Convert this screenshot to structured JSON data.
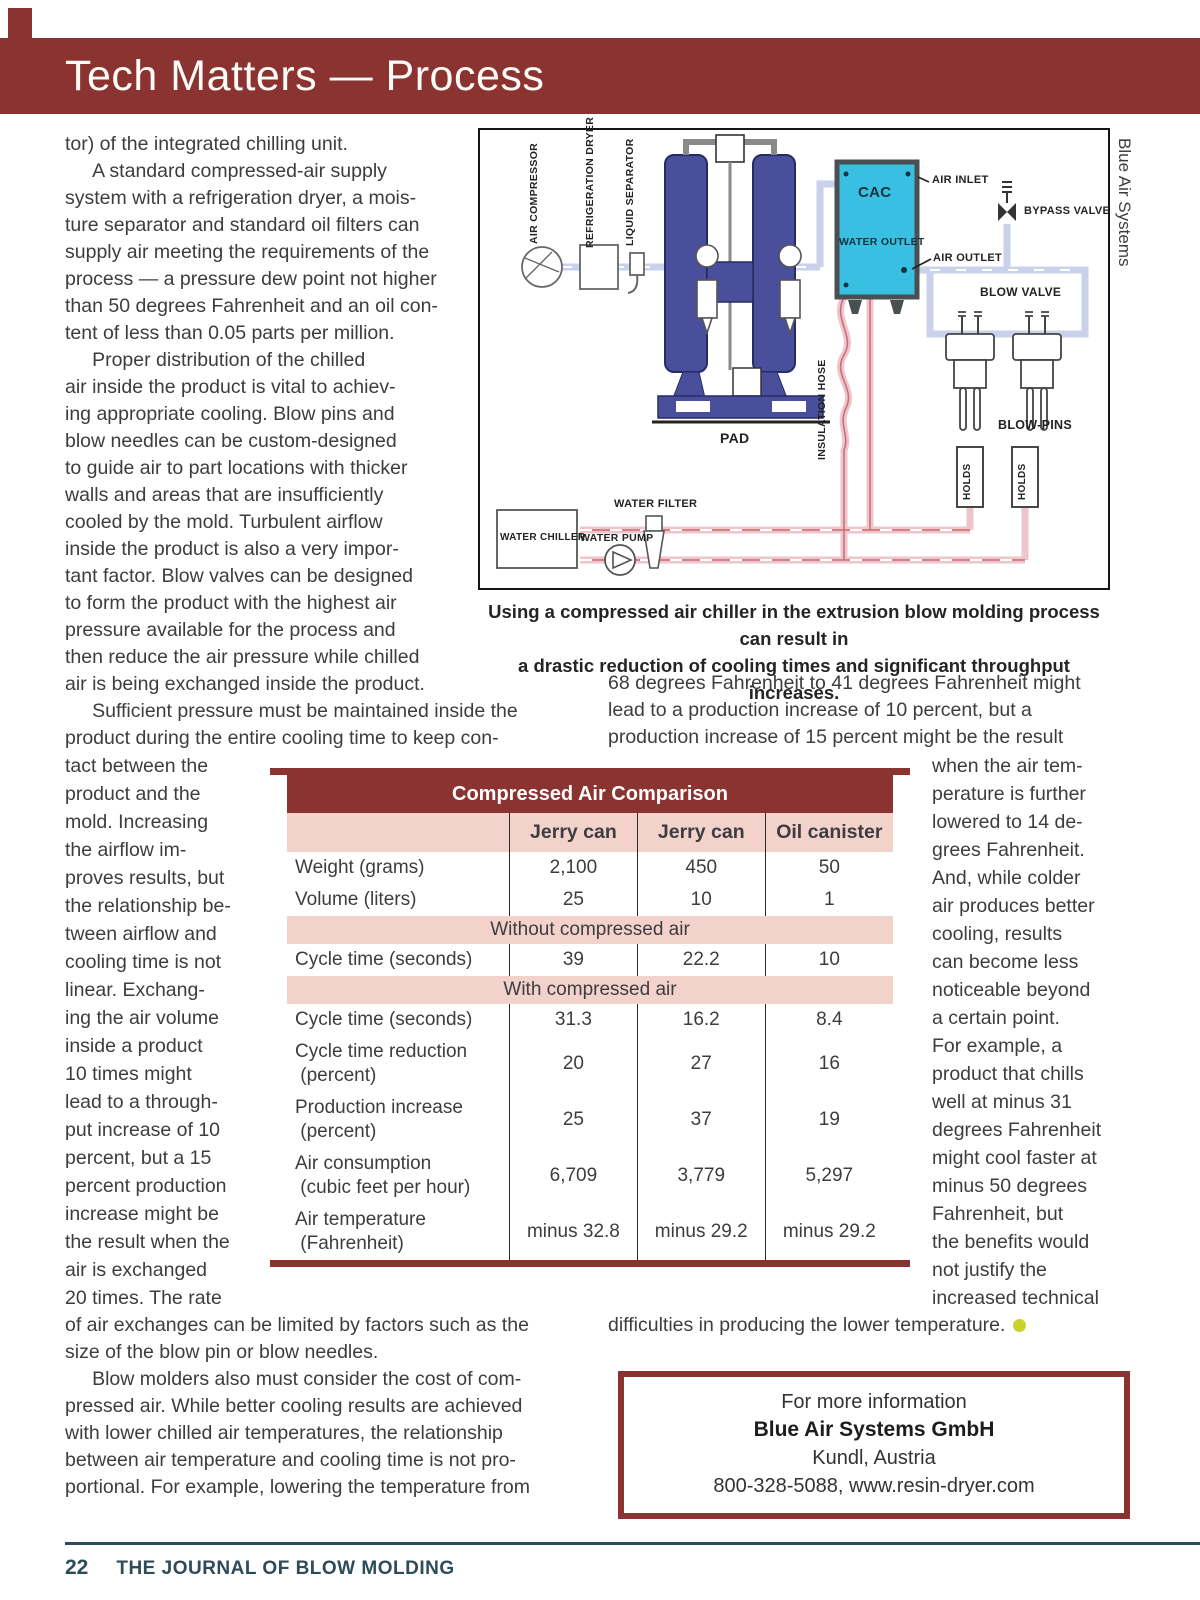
{
  "header": {
    "title": "Tech Matters — Process"
  },
  "article": {
    "col1_top": "tor) of the integrated chilling unit.\n     A standard compressed-air supply\nsystem with a refrigeration dryer, a mois-\nture separator and standard oil filters can\nsupply air meeting the requirements of the\nprocess — a pressure dew point not higher\nthan 50 degrees Fahrenheit and an oil con-\ntent of less than 0.05 parts per million.\n     Proper distribution of the chilled\nair inside the product is vital to achiev-\ning appropriate cooling. Blow pins and\nblow needles can be custom-designed\nto guide air to part locations with thicker\nwalls and areas that are insufficiently\ncooled by the mold. Turbulent airflow\ninside the product is also a very impor-\ntant factor. Blow valves can be designed\nto form the product with the highest air\npressure available for the process and\nthen reduce the air pressure while chilled\nair is being exchanged inside the product.",
    "col1_mid": "     Sufficient pressure must be maintained inside the\nproduct during the entire cooling time to keep con-",
    "col1_narrow": "tact between the\nproduct and the\nmold. Increasing\nthe airflow im-\nproves results, but\nthe relationship be-\ntween airflow and\ncooling time is not\nlinear. Exchang-\ning the air volume\ninside a product\n10 times might\nlead to a through-\nput increase of 10\npercent, but a 15\npercent production\nincrease might be\nthe result when the\nair is exchanged\n20 times. The rate",
    "col1_bottom": "of air exchanges can be limited by factors such as the\nsize of the blow pin or blow needles.\n     Blow molders also must consider the cost of com-\npressed air. While better cooling results are achieved\nwith lower chilled air temperatures, the relationship\nbetween air temperature and cooling time is not pro-\nportional. For example, lowering the temperature from",
    "col2_top": "68 degrees Fahrenheit to 41 degrees Fahrenheit might\nlead to a production increase of 10 percent, but a\nproduction increase of 15 percent might be the result",
    "col2_narrow": "when the air tem-\nperature is further\nlowered to 14 de-\ngrees Fahrenheit.\nAnd, while colder\nair produces better\ncooling, results\ncan become less\nnoticeable beyond\na certain point.\nFor example, a\nproduct that chills\nwell at minus 31\ndegrees Fahrenheit\nmight cool faster at\nminus 50 degrees\nFahrenheit, but\nthe benefits would\nnot justify the\nincreased technical",
    "col2_bottom": "difficulties in producing the lower temperature."
  },
  "caption": "Using a compressed air chiller in the extrusion blow molding process can result in\na drastic reduction of cooling times and significant throughput increases.",
  "diagram": {
    "credit": "Blue Air Systems",
    "labels": {
      "air_compressor": "AIR COMPRESSOR",
      "refrigeration_dryer": "REFRIGERATION DRYER",
      "liquid_separator": "LIQUID SEPARATOR",
      "cac": "CAC",
      "air_inlet": "AIR INLET",
      "bypass_valve": "BYPASS VALVE",
      "water_outlet": "WATER OUTLET",
      "air_outlet": "AIR OUTLET",
      "blow_valve": "BLOW VALVE",
      "pad": "PAD",
      "insulation_hose": "INSULATION HOSE",
      "blow_pins": "BLOW-PINS",
      "holds1": "HOLDS",
      "holds2": "HOLDS",
      "water_filter": "WATER FILTER",
      "water_chiller": "WATER CHILLER",
      "water_pump": "WATER PUMP"
    }
  },
  "table": {
    "title": "Compressed Air Comparison",
    "columns": [
      "",
      "Jerry can",
      "Jerry can",
      "Oil canister"
    ],
    "rows": [
      {
        "label": "Weight (grams)",
        "v1": "2,100",
        "v2": "450",
        "v3": "50"
      },
      {
        "label": "Volume (liters)",
        "v1": "25",
        "v2": "10",
        "v3": "1"
      },
      {
        "section": "Without compressed air"
      },
      {
        "label": "Cycle time (seconds)",
        "v1": "39",
        "v2": "22.2",
        "v3": "10"
      },
      {
        "section": "With compressed air"
      },
      {
        "label": "Cycle time (seconds)",
        "v1": "31.3",
        "v2": "16.2",
        "v3": "8.4"
      },
      {
        "label": "Cycle time reduction\n (percent)",
        "v1": "20",
        "v2": "27",
        "v3": "16"
      },
      {
        "label": "Production increase\n (percent)",
        "v1": "25",
        "v2": "37",
        "v3": "19"
      },
      {
        "label": "Air consumption\n (cubic feet per hour)",
        "v1": "6,709",
        "v2": "3,779",
        "v3": "5,297"
      },
      {
        "label": "Air temperature\n (Fahrenheit)",
        "v1": "minus 32.8",
        "v2": "minus 29.2",
        "v3": "minus 29.2"
      }
    ]
  },
  "info_box": {
    "line1": "For more information",
    "line2": "Blue Air Systems GmbH",
    "line3": "Kundl, Austria",
    "line4": "800-328-5088, www.resin-dryer.com"
  },
  "footer": {
    "page_number": "22",
    "journal": "THE JOURNAL OF BLOW MOLDING"
  }
}
